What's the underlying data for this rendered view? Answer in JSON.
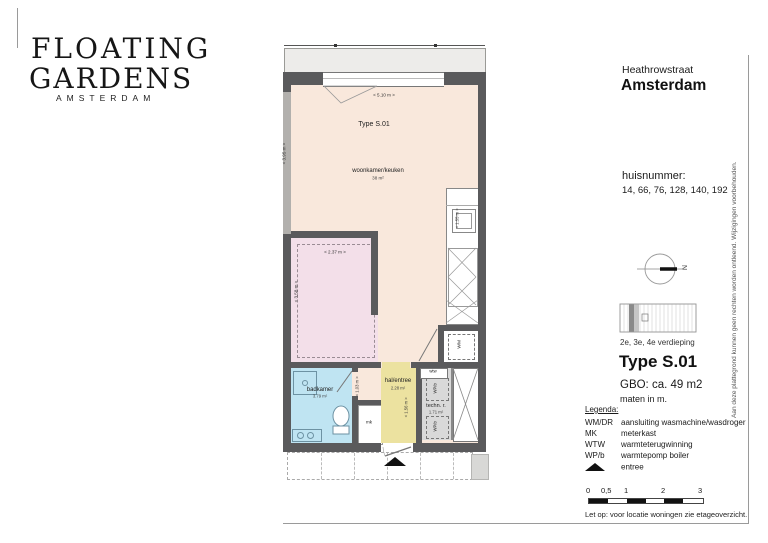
{
  "logo": {
    "line1": "FLOATING",
    "line2": "GARDENS",
    "line3": "AMSTERDAM"
  },
  "header": {
    "street": "Heathrowstraat",
    "city": "Amsterdam"
  },
  "huisnummer": {
    "label": "huisnummer:",
    "values": "14, 66, 76, 128, 140, 192"
  },
  "compass": {
    "north": "N"
  },
  "floor_info": {
    "verdieping": "2e, 3e, 4e verdieping",
    "type_title": "Type S.01",
    "gbo": "GBO: ca. 49 m2",
    "note": "maten in m."
  },
  "legend": {
    "title": "Legenda:",
    "items": [
      {
        "abbr": "WM/DR",
        "desc": "aansluiting wasmachine/wasdroger"
      },
      {
        "abbr": "MK",
        "desc": "meterkast"
      },
      {
        "abbr": "WTW",
        "desc": "warmteterugwinning"
      },
      {
        "abbr": "WP/b",
        "desc": "warmtepomp boiler"
      },
      {
        "abbr": "",
        "icon": "entree-triangle",
        "desc": "entree"
      }
    ]
  },
  "scalebar": {
    "ticks": [
      "0",
      "0,5",
      "1",
      "2",
      "3"
    ]
  },
  "notes": {
    "scale_note": "Let op: voor locatie woningen zie etageoverzicht.",
    "disclaimer": "Aan deze plattegrond kunnen geen rechten worden ontleend. Wijzigingen voorbehouden."
  },
  "plan": {
    "type_label": "Type S.01",
    "rooms": {
      "living": {
        "name": "woonkamer/keuken",
        "area": "38 m²"
      },
      "bathroom": {
        "name": "badkamer",
        "area": "3.79 m²"
      },
      "hall": {
        "name": "hal/entree",
        "area": "2.28 m²"
      },
      "tech": {
        "name": "techn. r.",
        "area": "1.71 m²"
      }
    },
    "labels": {
      "mk": "mk",
      "wm": "WM",
      "wtw": "wtw",
      "wpb": "WP/b"
    },
    "dims": {
      "top_width": "< 5.10 m >",
      "left_depth": "< 3.95 m >",
      "bed_width": "< 2.37 m >",
      "bed_depth": "< 3.58 m >",
      "bath": "< 1.03 m >",
      "hall": "< 1.56 m >",
      "kitchen": "< 1.55 m >"
    },
    "colors": {
      "living": "#f9e8dc",
      "bedroom": "#f3dfe9",
      "bathroom": "#bfe4f2",
      "hall": "#ece2a0",
      "tech": "#d9d9d9",
      "wall": "#5a5a5c"
    }
  }
}
